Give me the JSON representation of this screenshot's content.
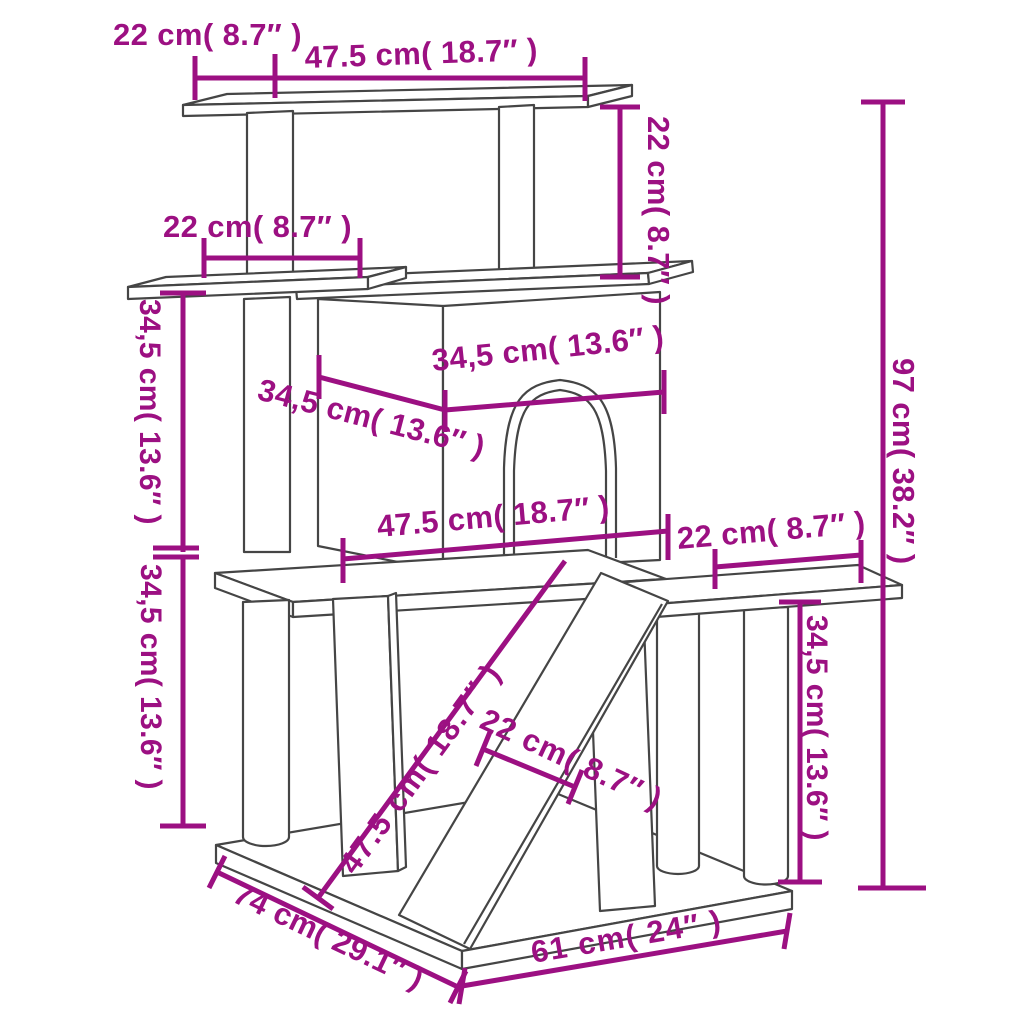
{
  "meta": {
    "title": "Cat tree with scratching posts — dimension diagram",
    "style": "technical line drawing with dimension annotations"
  },
  "colors": {
    "dimension": "#9C1082",
    "structure": "#454545",
    "background": "#ffffff"
  },
  "units": {
    "primary": "cm",
    "secondary": "inches"
  },
  "dimensions": [
    {
      "id": "top-left-overhang",
      "label": "22 cm( 8.7″ )",
      "value_cm": "22",
      "value_in": "8.7",
      "orientation": "horizontal"
    },
    {
      "id": "top-platform-width",
      "label": "47.5 cm( 18.7″ )",
      "value_cm": "47.5",
      "value_in": "18.7",
      "orientation": "horizontal"
    },
    {
      "id": "top-to-house-gap",
      "label": "22 cm( 8.7″ )",
      "value_cm": "22",
      "value_in": "8.7",
      "orientation": "vertical"
    },
    {
      "id": "total-height",
      "label": "97 cm( 38.2″ )",
      "value_cm": "97",
      "value_in": "38.2",
      "orientation": "vertical"
    },
    {
      "id": "shelf-width",
      "label": "22 cm( 8.7″ )",
      "value_cm": "22",
      "value_in": "8.7",
      "orientation": "horizontal"
    },
    {
      "id": "shelf-level-drop",
      "label": "34,5 cm( 13.6″ )",
      "value_cm": "34,5",
      "value_in": "13.6",
      "orientation": "vertical"
    },
    {
      "id": "mid-level-drop",
      "label": "34,5 cm( 13.6″ )",
      "value_cm": "34,5",
      "value_in": "13.6",
      "orientation": "vertical"
    },
    {
      "id": "house-depth",
      "label": "34,5 cm( 13.6″ )",
      "value_cm": "34,5",
      "value_in": "13.6",
      "orientation": "diagonal"
    },
    {
      "id": "house-width",
      "label": "34,5 cm( 13.6″ )",
      "value_cm": "34,5",
      "value_in": "13.6",
      "orientation": "horizontal"
    },
    {
      "id": "mid-platform-width",
      "label": "47.5 cm( 18.7″ )",
      "value_cm": "47.5",
      "value_in": "18.7",
      "orientation": "horizontal"
    },
    {
      "id": "right-platform-width",
      "label": "22 cm( 8.7″ )",
      "value_cm": "22",
      "value_in": "8.7",
      "orientation": "horizontal"
    },
    {
      "id": "right-platform-height",
      "label": "34,5 cm( 13.6″ )",
      "value_cm": "34,5",
      "value_in": "13.6",
      "orientation": "vertical"
    },
    {
      "id": "ramp-length",
      "label": "47.5 cm( 18.7″ )",
      "value_cm": "47.5",
      "value_in": "18.7",
      "orientation": "diagonal"
    },
    {
      "id": "ramp-width",
      "label": "22 cm( 8.7″ )",
      "value_cm": "22",
      "value_in": "8.7",
      "orientation": "diagonal"
    },
    {
      "id": "base-depth",
      "label": "74 cm( 29.1″ )",
      "value_cm": "74",
      "value_in": "29.1",
      "orientation": "diagonal"
    },
    {
      "id": "base-width",
      "label": "61 cm( 24″ )",
      "value_cm": "61",
      "value_in": "24",
      "orientation": "diagonal"
    }
  ]
}
